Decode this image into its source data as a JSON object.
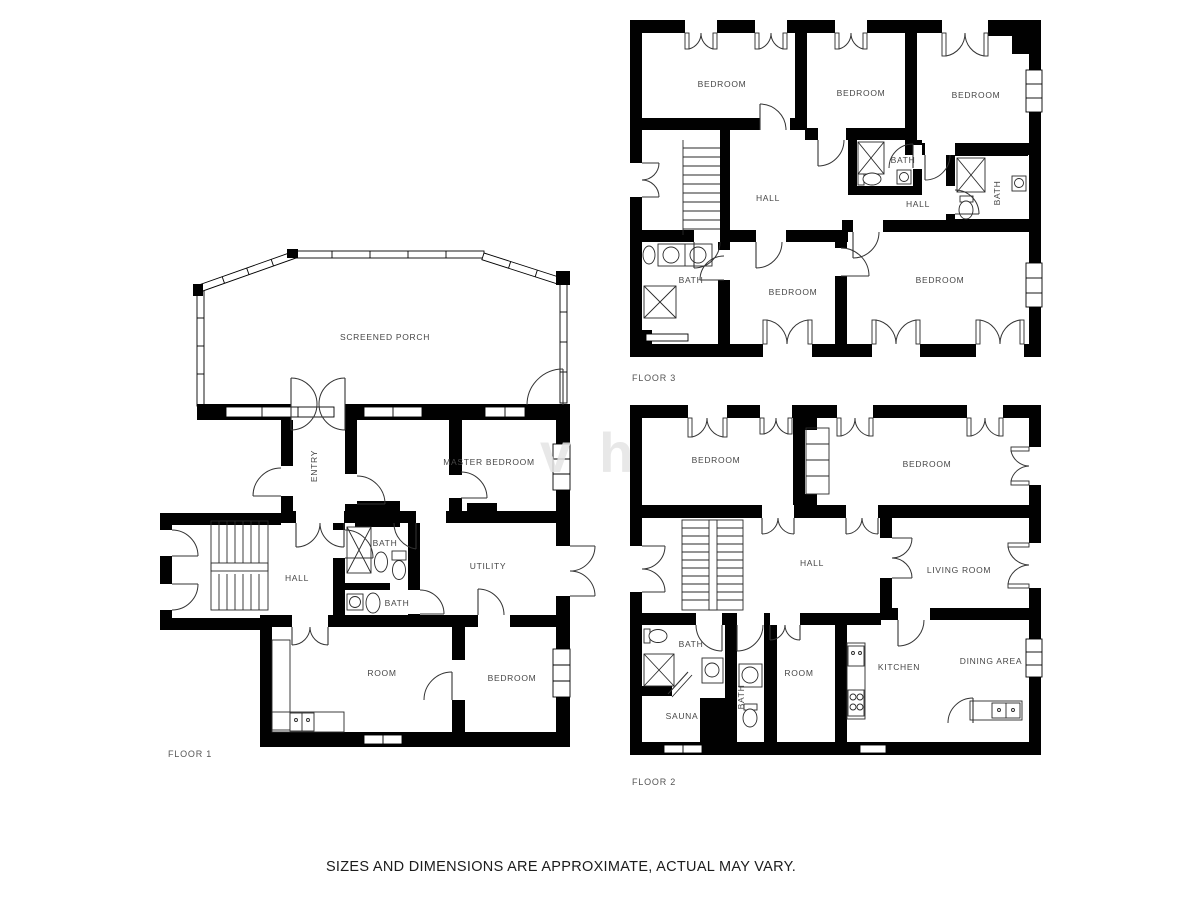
{
  "disclaimer": "SIZES AND DIMENSIONS ARE APPROXIMATE, ACTUAL MAY VARY.",
  "watermark": "vh",
  "floors": [
    {
      "id": "floor-1",
      "label": "FLOOR 1",
      "label_pos": {
        "x": 168,
        "y": 754
      },
      "rooms": [
        {
          "label": "SCREENED PORCH",
          "x": 385,
          "y": 337
        },
        {
          "label": "ENTRY",
          "x": 314,
          "y": 466,
          "vertical": true
        },
        {
          "label": "MASTER BEDROOM",
          "x": 489,
          "y": 462
        },
        {
          "label": "HALL",
          "x": 297,
          "y": 578
        },
        {
          "label": "BATH",
          "x": 385,
          "y": 543
        },
        {
          "label": "BATH",
          "x": 397,
          "y": 603
        },
        {
          "label": "UTILITY",
          "x": 488,
          "y": 566
        },
        {
          "label": "ROOM",
          "x": 382,
          "y": 673
        },
        {
          "label": "BEDROOM",
          "x": 512,
          "y": 678
        }
      ]
    },
    {
      "id": "floor-2",
      "label": "FLOOR 2",
      "label_pos": {
        "x": 632,
        "y": 782
      },
      "rooms": [
        {
          "label": "BEDROOM",
          "x": 716,
          "y": 460
        },
        {
          "label": "BEDROOM",
          "x": 927,
          "y": 464
        },
        {
          "label": "HALL",
          "x": 812,
          "y": 563
        },
        {
          "label": "LIVING ROOM",
          "x": 959,
          "y": 570
        },
        {
          "label": "BATH",
          "x": 691,
          "y": 644
        },
        {
          "label": "SAUNA",
          "x": 682,
          "y": 716
        },
        {
          "label": "BATH",
          "x": 741,
          "y": 697,
          "vertical": true
        },
        {
          "label": "ROOM",
          "x": 799,
          "y": 673
        },
        {
          "label": "KITCHEN",
          "x": 899,
          "y": 667
        },
        {
          "label": "DINING AREA",
          "x": 991,
          "y": 661
        }
      ]
    },
    {
      "id": "floor-3",
      "label": "FLOOR 3",
      "label_pos": {
        "x": 632,
        "y": 378
      },
      "rooms": [
        {
          "label": "BEDROOM",
          "x": 722,
          "y": 84
        },
        {
          "label": "BEDROOM",
          "x": 861,
          "y": 93
        },
        {
          "label": "BEDROOM",
          "x": 976,
          "y": 95
        },
        {
          "label": "BATH",
          "x": 903,
          "y": 160
        },
        {
          "label": "HALL",
          "x": 768,
          "y": 198
        },
        {
          "label": "HALL",
          "x": 918,
          "y": 204
        },
        {
          "label": "BATH",
          "x": 997,
          "y": 193,
          "vertical": true
        },
        {
          "label": "BATH",
          "x": 691,
          "y": 280
        },
        {
          "label": "BEDROOM",
          "x": 793,
          "y": 292
        },
        {
          "label": "BEDROOM",
          "x": 940,
          "y": 280
        }
      ]
    }
  ]
}
